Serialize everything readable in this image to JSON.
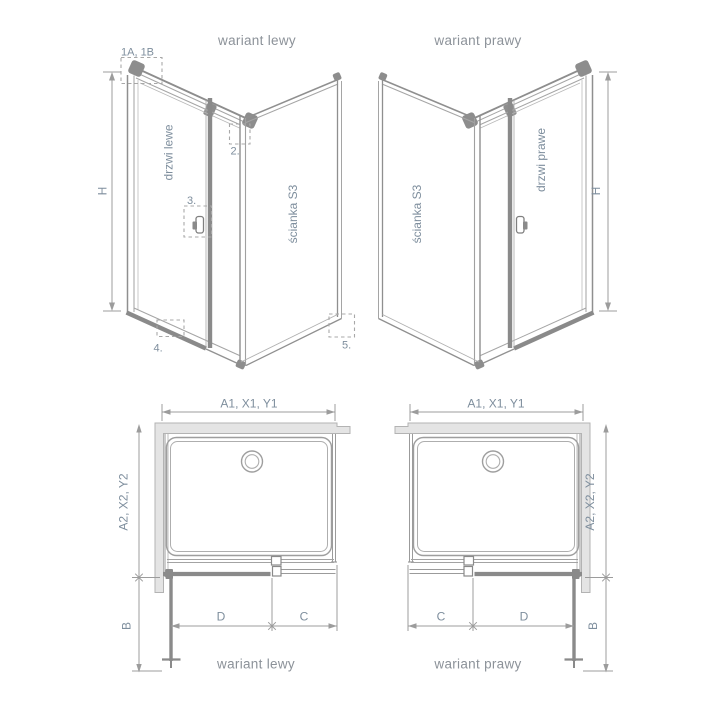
{
  "colors": {
    "background": "#ffffff",
    "line_gray": "#9b9b9b",
    "profile_dark_gray": "#8a8a8a",
    "wall_fill": "#e4e4e4",
    "wall_stroke": "#b3b3b3",
    "label_text": "#7e8e9d",
    "title_text": "#8c9299"
  },
  "top_left": {
    "title": "wariant lewy",
    "door_label": "drzwi lewe",
    "wall_label": "ścianka S3",
    "height_label": "H",
    "callout_1": "1A, 1B",
    "callout_2": "2.",
    "callout_3": "3.",
    "callout_4": "4.",
    "callout_5": "5."
  },
  "top_right": {
    "title": "wariant prawy",
    "door_label": "drzwi prawe",
    "wall_label": "ścianka S3",
    "height_label": "H"
  },
  "bottom_left": {
    "caption": "wariant lewy",
    "width_label": "A1, X1, Y1",
    "depth_label": "A2, X2, Y2",
    "door_swing_label": "B",
    "door_width_label": "D",
    "fixed_width_label": "C"
  },
  "bottom_right": {
    "caption": "wariant prawy",
    "width_label": "A1, X1, Y1",
    "depth_label": "A2, X2, Y2",
    "door_swing_label": "B",
    "door_width_label": "D",
    "fixed_width_label": "C"
  }
}
